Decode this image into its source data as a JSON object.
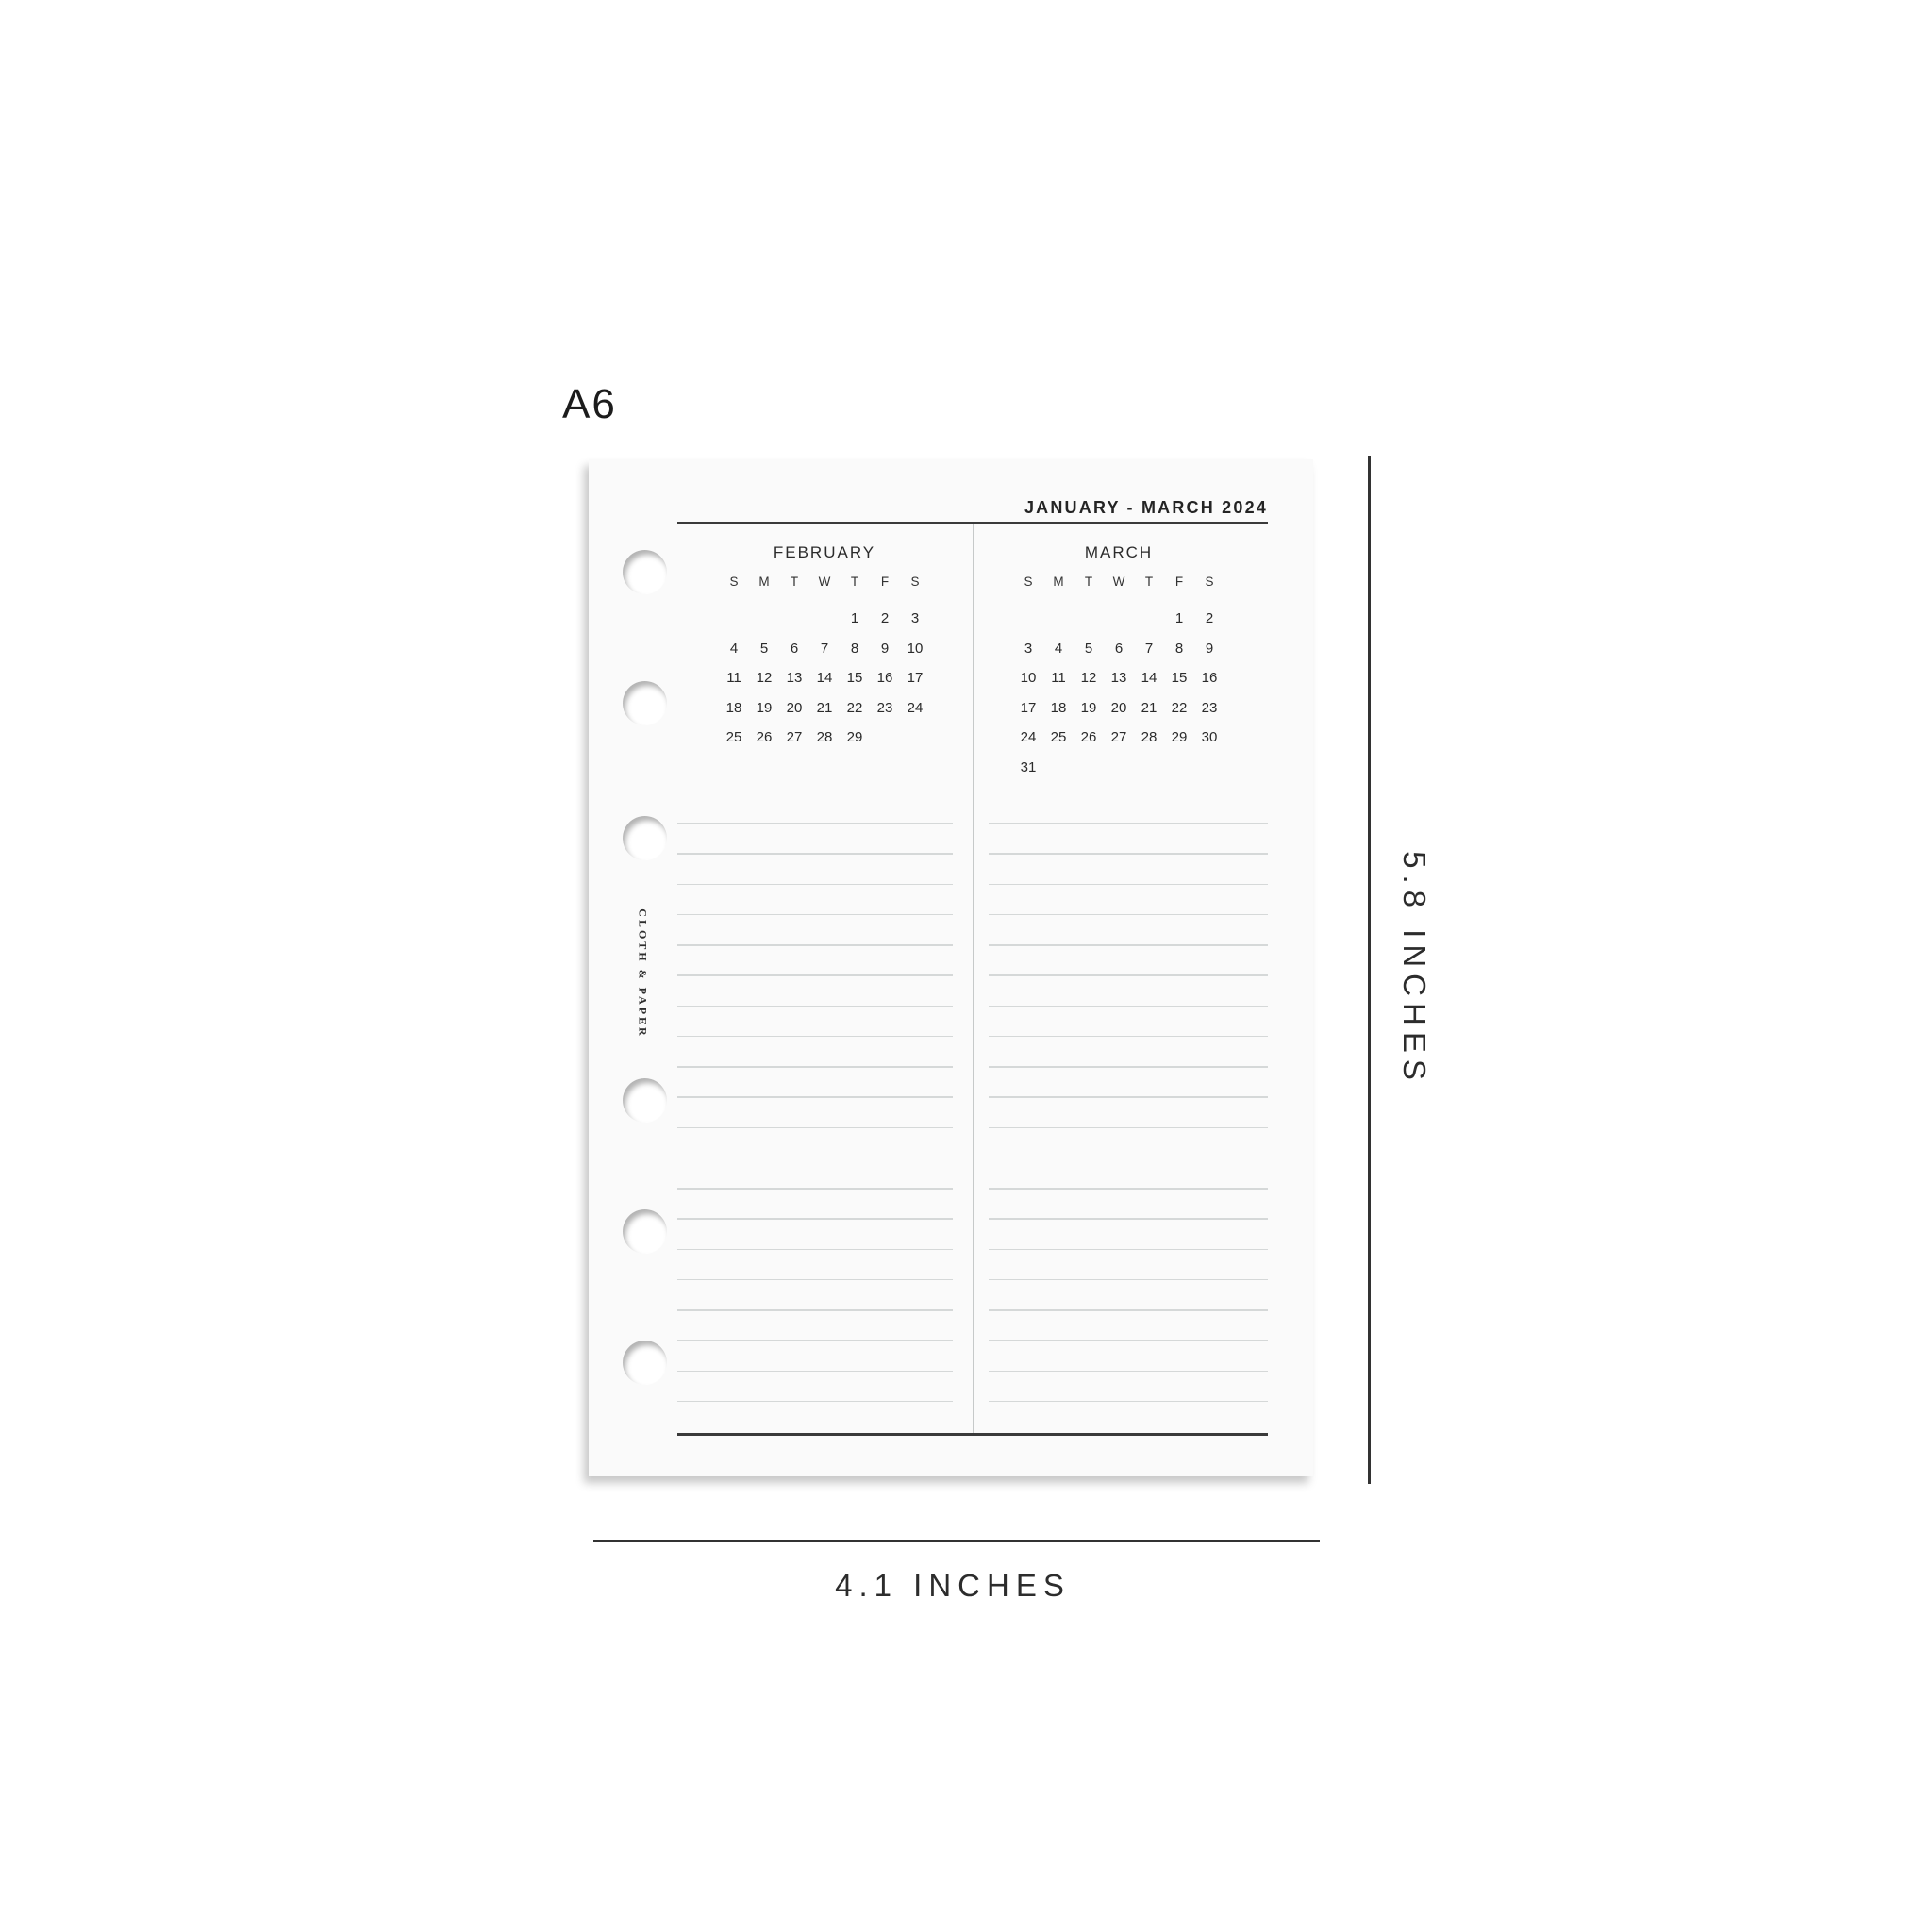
{
  "size_label": "A6",
  "page": {
    "header_title": "JANUARY - MARCH 2024",
    "brand_vertical": "CLOTH & PAPER",
    "months": [
      {
        "title": "FEBRUARY",
        "day_headers": [
          "S",
          "M",
          "T",
          "W",
          "T",
          "F",
          "S"
        ],
        "weeks": [
          [
            "",
            "",
            "",
            "",
            "1",
            "2",
            "3"
          ],
          [
            "4",
            "5",
            "6",
            "7",
            "8",
            "9",
            "10"
          ],
          [
            "11",
            "12",
            "13",
            "14",
            "15",
            "16",
            "17"
          ],
          [
            "18",
            "19",
            "20",
            "21",
            "22",
            "23",
            "24"
          ],
          [
            "25",
            "26",
            "27",
            "28",
            "29",
            "",
            ""
          ]
        ]
      },
      {
        "title": "MARCH",
        "day_headers": [
          "S",
          "M",
          "T",
          "W",
          "T",
          "F",
          "S"
        ],
        "weeks": [
          [
            "",
            "",
            "",
            "",
            "",
            "1",
            "2"
          ],
          [
            "3",
            "4",
            "5",
            "6",
            "7",
            "8",
            "9"
          ],
          [
            "10",
            "11",
            "12",
            "13",
            "14",
            "15",
            "16"
          ],
          [
            "17",
            "18",
            "19",
            "20",
            "21",
            "22",
            "23"
          ],
          [
            "24",
            "25",
            "26",
            "27",
            "28",
            "29",
            "30"
          ],
          [
            "31",
            "",
            "",
            "",
            "",
            "",
            ""
          ]
        ]
      }
    ],
    "notes_lines_per_column": 20
  },
  "dimension_annotations": {
    "height_label": "5.8 INCHES",
    "width_label": "4.1 INCHES"
  },
  "colors": {
    "background": "#ffffff",
    "paper": "#fafafa",
    "ink": "#2a2a2a",
    "rule_line": "#d5d8d8",
    "divider": "#c6c9c9",
    "strong_line": "#3a3a3a"
  }
}
